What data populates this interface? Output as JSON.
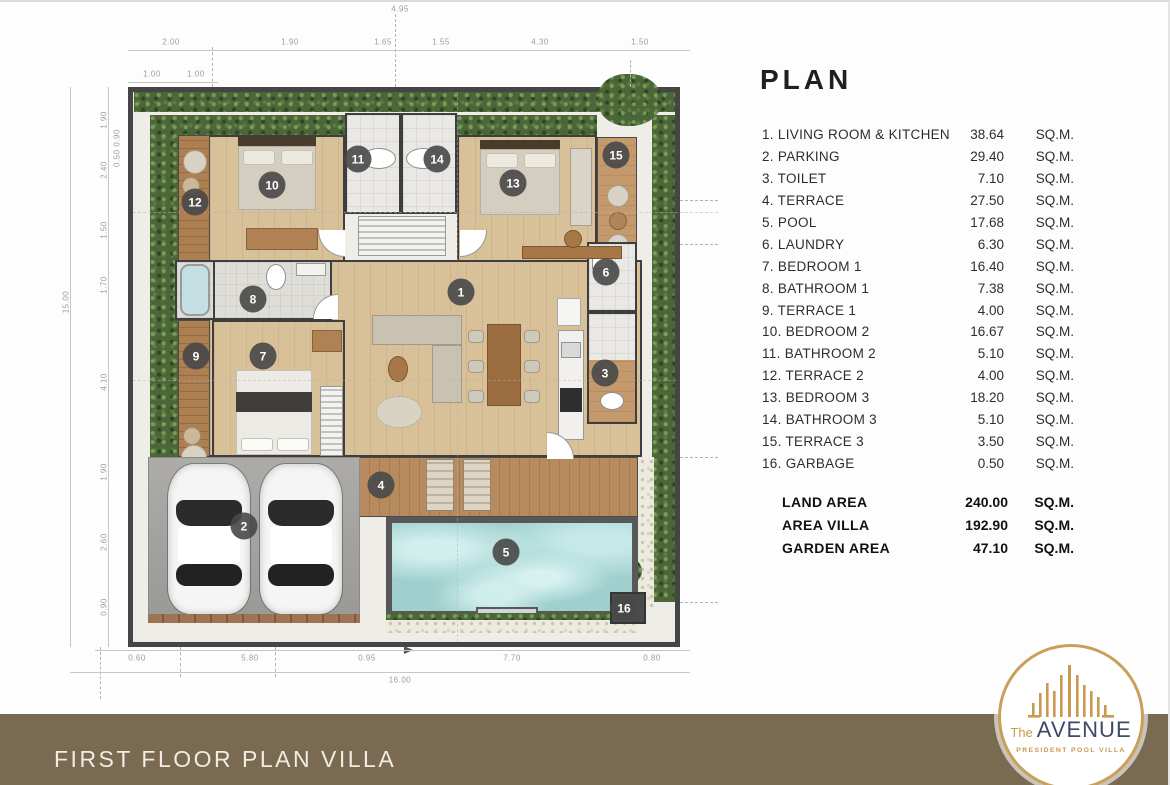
{
  "legend": {
    "title": "PLAN",
    "unit": "SQ.M.",
    "items": [
      {
        "name": "1. LIVING ROOM & KITCHEN",
        "value": "38.64"
      },
      {
        "name": "2. PARKING",
        "value": "29.40"
      },
      {
        "name": "3. TOILET",
        "value": "7.10"
      },
      {
        "name": "4. TERRACE",
        "value": "27.50"
      },
      {
        "name": "5. POOL",
        "value": "17.68"
      },
      {
        "name": "6. LAUNDRY",
        "value": "6.30"
      },
      {
        "name": "7. BEDROOM 1",
        "value": "16.40"
      },
      {
        "name": "8. BATHROOM 1",
        "value": "7.38"
      },
      {
        "name": "9. TERRACE 1",
        "value": "4.00"
      },
      {
        "name": "10. BEDROOM 2",
        "value": "16.67"
      },
      {
        "name": "11. BATHROOM 2",
        "value": "5.10"
      },
      {
        "name": "12. TERRACE 2",
        "value": "4.00"
      },
      {
        "name": "13. BEDROOM 3",
        "value": "18.20"
      },
      {
        "name": "14. BATHROOM 3",
        "value": "5.10"
      },
      {
        "name": "15. TERRACE 3",
        "value": "3.50"
      },
      {
        "name": "16. GARBAGE",
        "value": "0.50"
      }
    ],
    "totals": [
      {
        "name": "LAND AREA",
        "value": "240.00"
      },
      {
        "name": "AREA  VILLA",
        "value": "192.90"
      },
      {
        "name": "GARDEN AREA",
        "value": "47.10"
      }
    ]
  },
  "footer": {
    "title": "FIRST FLOOR PLAN VILLA"
  },
  "logo": {
    "the": "The",
    "name": "AVENUE",
    "subtitle": "PRESIDENT POOL VILLA"
  },
  "plan": {
    "markers": [
      {
        "n": "1",
        "x": 461,
        "y": 290
      },
      {
        "n": "2",
        "x": 244,
        "y": 524
      },
      {
        "n": "3",
        "x": 605,
        "y": 371
      },
      {
        "n": "4",
        "x": 381,
        "y": 483
      },
      {
        "n": "5",
        "x": 506,
        "y": 550
      },
      {
        "n": "6",
        "x": 606,
        "y": 270
      },
      {
        "n": "7",
        "x": 263,
        "y": 354
      },
      {
        "n": "8",
        "x": 253,
        "y": 297
      },
      {
        "n": "9",
        "x": 196,
        "y": 354
      },
      {
        "n": "10",
        "x": 272,
        "y": 183
      },
      {
        "n": "11",
        "x": 358,
        "y": 157
      },
      {
        "n": "12",
        "x": 195,
        "y": 200
      },
      {
        "n": "13",
        "x": 513,
        "y": 181
      },
      {
        "n": "14",
        "x": 437,
        "y": 157
      },
      {
        "n": "15",
        "x": 616,
        "y": 153
      },
      {
        "n": "16",
        "x": 624,
        "y": 606
      }
    ],
    "dimensions": [
      {
        "t": "4.95",
        "x": 400,
        "y": 7
      },
      {
        "t": "2.00",
        "x": 171,
        "y": 40
      },
      {
        "t": "1.90",
        "x": 290,
        "y": 40
      },
      {
        "t": "1.65",
        "x": 383,
        "y": 40
      },
      {
        "t": "1.55",
        "x": 441,
        "y": 40
      },
      {
        "t": "4.30",
        "x": 540,
        "y": 40
      },
      {
        "t": "1.50",
        "x": 640,
        "y": 40
      },
      {
        "t": "1.00",
        "x": 152,
        "y": 72
      },
      {
        "t": "1.00",
        "x": 196,
        "y": 72
      },
      {
        "t": "1.90",
        "x": 104,
        "y": 118,
        "rot": true
      },
      {
        "t": "0.50 0.90",
        "x": 117,
        "y": 146,
        "rot": true
      },
      {
        "t": "2.40",
        "x": 104,
        "y": 168,
        "rot": true
      },
      {
        "t": "1.50",
        "x": 104,
        "y": 228,
        "rot": true
      },
      {
        "t": "1.70",
        "x": 104,
        "y": 283,
        "rot": true
      },
      {
        "t": "4.10",
        "x": 104,
        "y": 380,
        "rot": true
      },
      {
        "t": "1.90",
        "x": 104,
        "y": 470,
        "rot": true
      },
      {
        "t": "2.60",
        "x": 104,
        "y": 540,
        "rot": true
      },
      {
        "t": "0.90",
        "x": 104,
        "y": 605,
        "rot": true
      },
      {
        "t": "15.00",
        "x": 66,
        "y": 300,
        "rot": true
      },
      {
        "t": "0.60",
        "x": 137,
        "y": 656
      },
      {
        "t": "5.80",
        "x": 250,
        "y": 656
      },
      {
        "t": "0.95",
        "x": 367,
        "y": 656
      },
      {
        "t": "7.70",
        "x": 512,
        "y": 656
      },
      {
        "t": "0.80",
        "x": 652,
        "y": 656
      },
      {
        "t": "16.00",
        "x": 400,
        "y": 678
      }
    ]
  }
}
